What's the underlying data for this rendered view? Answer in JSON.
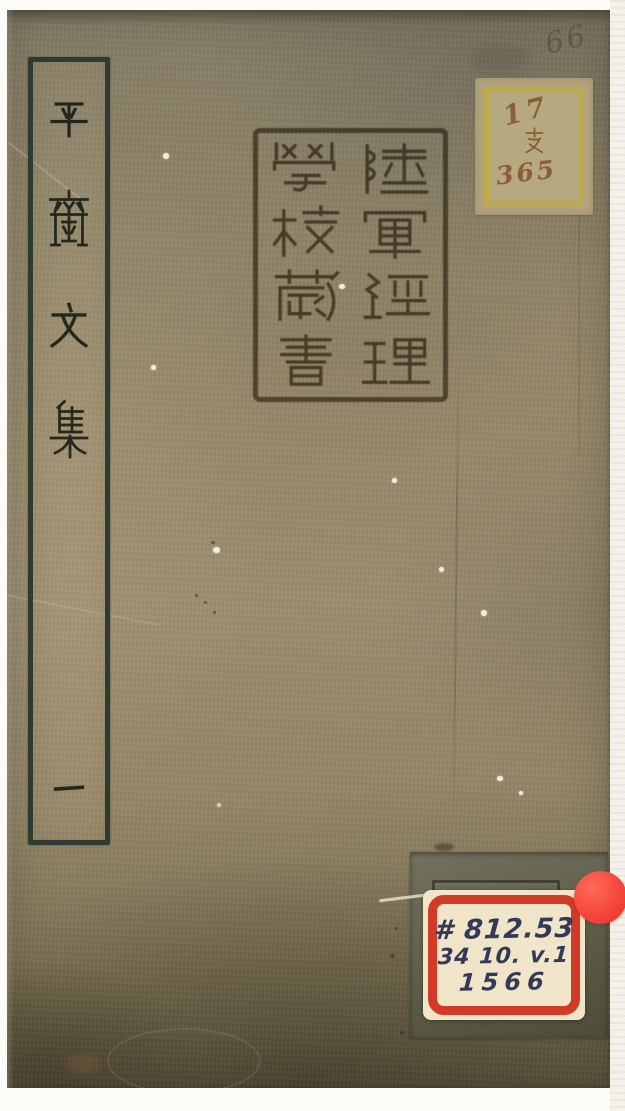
{
  "page": {
    "description": "Photograph of the front cover of a traditional Chinese stitched-bound book on a white scan background"
  },
  "cover": {
    "title_label": {
      "title": "平齋文集",
      "characters": [
        "平",
        "齋",
        "文",
        "集"
      ],
      "volume": "一",
      "frame_color": "#2d3b33"
    },
    "library_seal": {
      "text": "陸軍經理學校藏書",
      "right_column": [
        "陸",
        "軍",
        "經",
        "理"
      ],
      "left_column": [
        "學",
        "校",
        "藏",
        "書"
      ],
      "ink_color": "#6d604c"
    },
    "shelf_label": {
      "line1": "17",
      "line2": "支",
      "line3": "365",
      "border_color": "#c0aa3d",
      "ink_color": "#8a5d3b"
    },
    "handwritten_number": "66",
    "call_number_label": {
      "line1": "# 812.53",
      "line2": "34 10. v.1",
      "line3": "1566",
      "border_color": "#d23a28",
      "ink_color": "#333a58",
      "paper_color": "#f0e5c9"
    },
    "red_dot_sticker_color": "#f23d33",
    "cover_color": "#968869"
  }
}
